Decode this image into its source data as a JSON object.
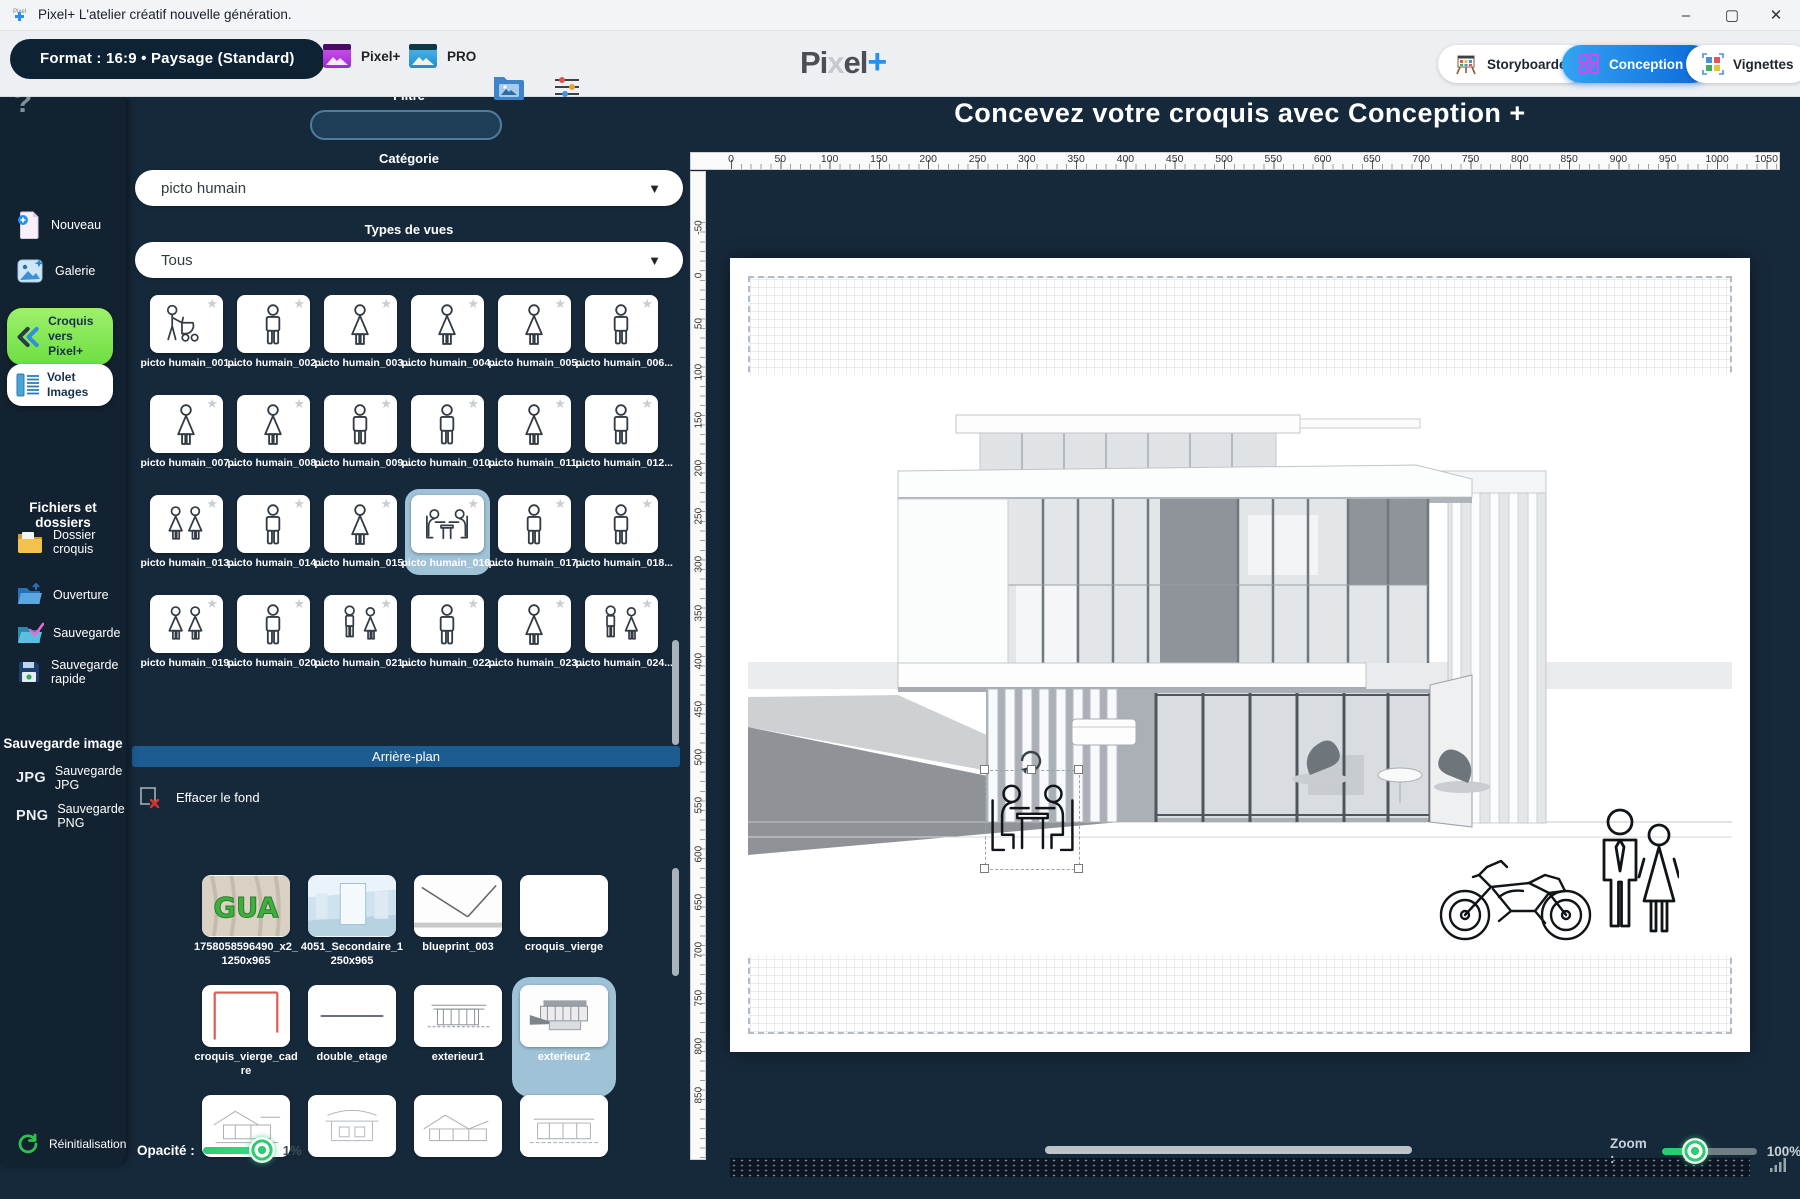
{
  "window": {
    "title": "Pixel+  L'atelier créatif nouvelle génération.",
    "minimize": "–",
    "maximize": "▢",
    "close": "✕"
  },
  "toolbar": {
    "format_pill": "Format : 16:9  •  Paysage (Standard)",
    "pixel_button": "Pixel+",
    "pro_button": "PRO",
    "logo_part1": "Pi",
    "logo_part2": "x",
    "logo_part3": "el",
    "logo_plus": "+",
    "storyboarder_button": "Storyboarder",
    "conception_button": "Conception +",
    "vignettes_button": "Vignettes"
  },
  "sidebar": {
    "help": "?",
    "nouveau": "Nouveau",
    "galerie": "Galerie",
    "croquis_line1": "Croquis",
    "croquis_line2": "vers Pixel+",
    "volet_line1": "Volet",
    "volet_line2": "Images",
    "files_heading": "Fichiers et dossiers",
    "dossier_label": "Dossier croquis",
    "ouverture": "Ouverture",
    "sauvegarde": "Sauvegarde",
    "sauvegarde_rapide": "Sauvegarde rapide",
    "image_heading": "Sauvegarde image",
    "jpg_icon": "JPG",
    "jpg_label": "Sauvegarde JPG",
    "png_icon": "PNG",
    "png_label": "Sauvegarde PNG",
    "reinit": "Réinitialisation"
  },
  "panel": {
    "filtre_label": "Filtre",
    "filtre_value": "",
    "categorie_label": "Catégorie",
    "categorie_value": "picto humain",
    "types_label": "Types de vues",
    "types_value": "Tous",
    "chevron": "▼",
    "star": "★",
    "pictos": [
      {
        "label": "picto humain_001...",
        "icon": "p-stroller"
      },
      {
        "label": "picto humain_002...",
        "icon": "p-man"
      },
      {
        "label": "picto humain_003...",
        "icon": "p-woman"
      },
      {
        "label": "picto humain_004...",
        "icon": "p-woman"
      },
      {
        "label": "picto humain_005...",
        "icon": "p-woman"
      },
      {
        "label": "picto humain_006...",
        "icon": "p-man"
      },
      {
        "label": "picto humain_007...",
        "icon": "p-woman"
      },
      {
        "label": "picto humain_008...",
        "icon": "p-woman"
      },
      {
        "label": "picto humain_009...",
        "icon": "p-man"
      },
      {
        "label": "picto humain_010...",
        "icon": "p-man"
      },
      {
        "label": "picto humain_011...",
        "icon": "p-woman"
      },
      {
        "label": "picto humain_012...",
        "icon": "p-man"
      },
      {
        "label": "picto humain_013...",
        "icon": "p-pair"
      },
      {
        "label": "picto humain_014...",
        "icon": "p-man"
      },
      {
        "label": "picto humain_015...",
        "icon": "p-woman"
      },
      {
        "label": "picto humain_016...",
        "icon": "p-table",
        "selected": true
      },
      {
        "label": "picto humain_017...",
        "icon": "p-man"
      },
      {
        "label": "picto humain_018...",
        "icon": "p-man"
      },
      {
        "label": "picto humain_019...",
        "icon": "p-pair"
      },
      {
        "label": "picto humain_020...",
        "icon": "p-man"
      },
      {
        "label": "picto humain_021...",
        "icon": "p-mw"
      },
      {
        "label": "picto humain_022...",
        "icon": "p-man"
      },
      {
        "label": "picto humain_023...",
        "icon": "p-woman"
      },
      {
        "label": "picto humain_024...",
        "icon": "p-mw"
      }
    ],
    "arriere_plan_label": "Arrière-plan",
    "effacer_label": "Effacer le fond",
    "backgrounds": [
      {
        "label": "1758058596490_x2_1250x965",
        "icon": "t-gua"
      },
      {
        "label": "4051_Secondaire_1250x965",
        "icon": "t-interior"
      },
      {
        "label": "blueprint_003",
        "icon": "t-blueprint"
      },
      {
        "label": "croquis_vierge",
        "icon": "t-blank"
      },
      {
        "label": "croquis_vierge_cadre",
        "icon": "t-redframe"
      },
      {
        "label": "double_etage",
        "icon": "t-line"
      },
      {
        "label": "exterieur1",
        "icon": "t-sketch1"
      },
      {
        "label": "exterieur2",
        "icon": "t-sketch2",
        "selected": true
      },
      {
        "label": "",
        "icon": "t-sketch3"
      },
      {
        "label": "",
        "icon": "t-sketch4"
      },
      {
        "label": "",
        "icon": "t-sketch5"
      },
      {
        "label": "",
        "icon": "t-sketch6"
      }
    ],
    "opacite_label": "Opacité  :",
    "opacite_value": "1%"
  },
  "canvas": {
    "heading": "Concevez votre croquis avec Conception +",
    "h_ticks": [
      "0",
      "50",
      "100",
      "150",
      "200",
      "250",
      "300",
      "350",
      "400",
      "450",
      "500",
      "550",
      "600",
      "650",
      "700",
      "750",
      "800",
      "850",
      "900",
      "950",
      "1000",
      "1050"
    ],
    "v_ticks": [
      "-50",
      "0",
      "50",
      "100",
      "150",
      "200",
      "250",
      "300",
      "350",
      "400",
      "450",
      "500",
      "550",
      "600",
      "650",
      "700",
      "750",
      "800",
      "850"
    ],
    "zoom_label": "Zoom :",
    "zoom_value": "100%"
  },
  "colors": {
    "accent_blue": "#0b67da",
    "accent_green": "#7ddf4c",
    "slider_green": "#2ecc71",
    "panel_bar_blue": "#1c5c90",
    "dark_bg": "#16293b",
    "selection_blue": "#9fc2d6"
  }
}
